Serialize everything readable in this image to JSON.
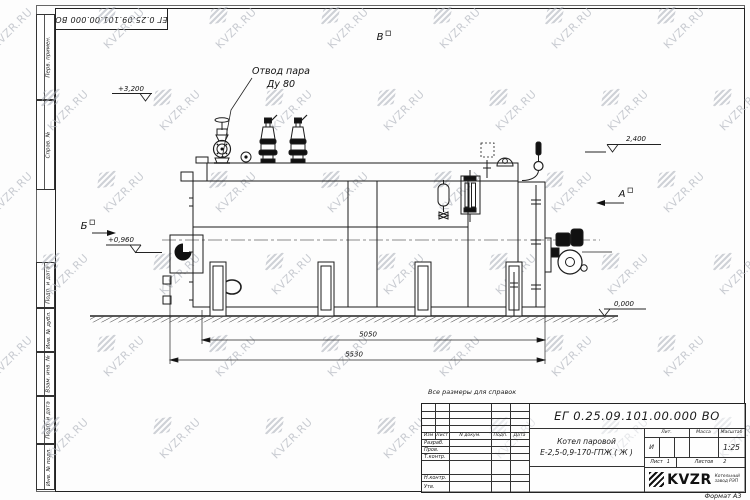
{
  "page": {
    "format_label": "Формат А3"
  },
  "watermark": {
    "text": "KVZR.RU"
  },
  "corner_stamp": {
    "doc_number": "ЕГ 0.25.09.101.00.000  ВО"
  },
  "margin_labels": {
    "perv_primen": "Перв. примен.",
    "sprav_no": "Справ. №",
    "podp_data_1": "Подп. и дата",
    "inv_dubl": "Инв. № дубл.",
    "vzam_inv": "Взам. инв. №",
    "podp_data_2": "Подп. и дата",
    "inv_podl": "Инв. № подл."
  },
  "drawing": {
    "callout_line1": "Отвод пара",
    "callout_line2": "Ду 80",
    "elevation_3200": "+3,200",
    "elevation_2400": "2,400",
    "elevation_0960": "+0,960",
    "elevation_0000": "0,000",
    "view_b": "Б",
    "view_v": "В",
    "view_a": "А",
    "dim_5050": "5050",
    "dim_5530": "5530"
  },
  "note": "Все размеры для справок",
  "title_block": {
    "doc_number": "ЕГ 0.25.09.101.00.000  ВО",
    "product_line1": "Котел паровой",
    "product_line2": "Е-2,5-0,9-170-ГПЖ ( Ж )",
    "col_izm": "Изм",
    "col_list": "Лист",
    "col_ndoc": "N докум.",
    "col_podp": "Подп.",
    "col_data": "Дата",
    "row_razrab": "Разраб.",
    "row_prov": "Пров.",
    "row_tkontr": "Т.контр.",
    "row_nkontr": "Н.контр.",
    "row_utv": "Утв.",
    "lit_header": "Лит.",
    "mass_header": "Масса",
    "scale_header": "Масштаб",
    "lit_value": "И",
    "scale_value": "1:25",
    "sheet_label": "Лист",
    "sheet_value": "1",
    "sheets_label": "Листов",
    "sheets_value": "2",
    "logo_text": "KVZR",
    "logo_caption1": "Котельный",
    "logo_caption2": "завод РЭП"
  }
}
